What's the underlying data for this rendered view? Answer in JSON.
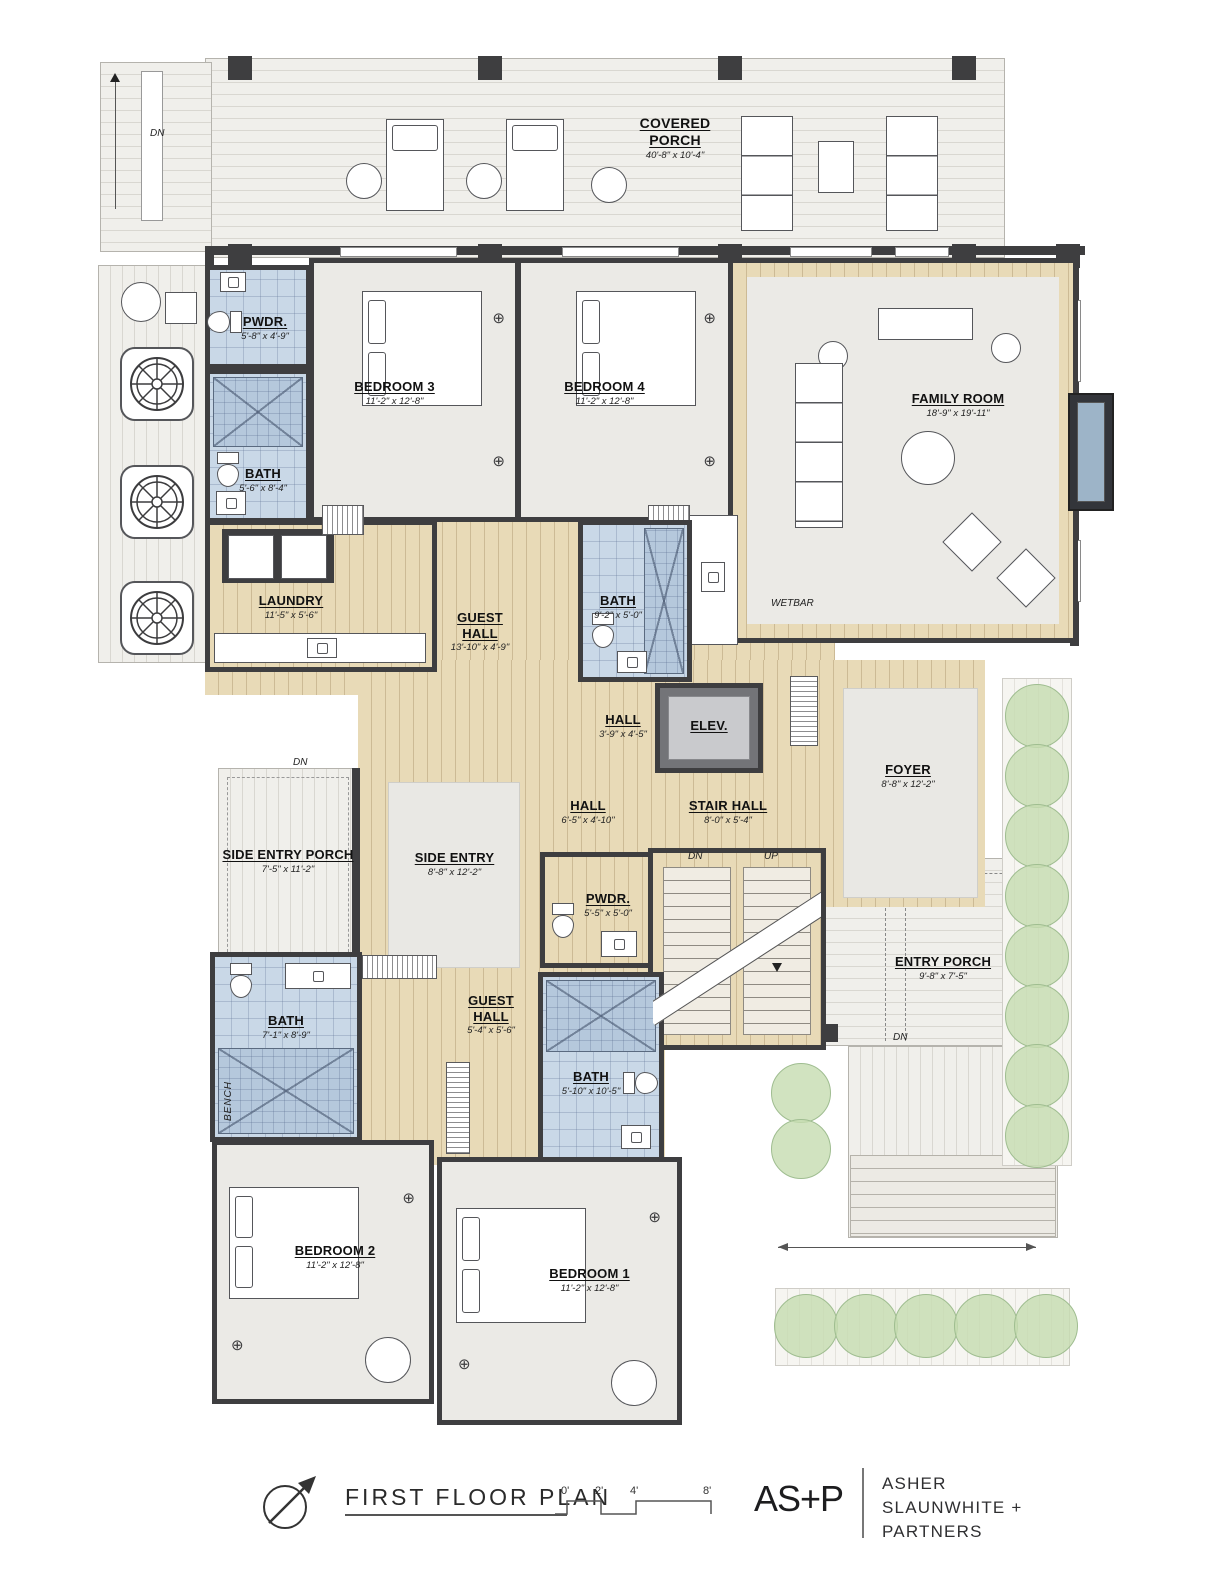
{
  "plan": {
    "rooms": {
      "covered_porch": {
        "name": "COVERED PORCH",
        "dim": "40'-8\" x 10'-4\""
      },
      "pwdr_upper": {
        "name": "PWDR.",
        "dim": "5'-8\" x 4'-9\""
      },
      "bath_upper": {
        "name": "BATH",
        "dim": "5'-6\" x 8'-4\""
      },
      "bedroom3": {
        "name": "BEDROOM 3",
        "dim": "11'-2\" x 12'-8\""
      },
      "bedroom4": {
        "name": "BEDROOM 4",
        "dim": "11'-2\" x 12'-8\""
      },
      "family_room": {
        "name": "FAMILY ROOM",
        "dim": "18'-9\" x 19'-11\""
      },
      "laundry": {
        "name": "LAUNDRY",
        "dim": "11'-5\" x 5'-6\""
      },
      "guest_hall_upper": {
        "name": "GUEST HALL",
        "dim": "13'-10\" x 4'-9\""
      },
      "bath_center": {
        "name": "BATH",
        "dim": "9'-2\" x 5'-0\""
      },
      "hall_small": {
        "name": "HALL",
        "dim": "3'-9\" x 4'-5\""
      },
      "elevator": {
        "name": "ELEV."
      },
      "foyer": {
        "name": "FOYER",
        "dim": "8'-8\" x 12'-2\""
      },
      "hall_center": {
        "name": "HALL",
        "dim": "6'-5\" x 4'-10\""
      },
      "stair_hall": {
        "name": "STAIR HALL",
        "dim": "8'-0\" x 5'-4\""
      },
      "side_entry_porch": {
        "name": "SIDE ENTRY PORCH",
        "dim": "7'-5\" x 11'-2\""
      },
      "side_entry": {
        "name": "SIDE ENTRY",
        "dim": "8'-8\" x 12'-2\""
      },
      "pwdr_lower": {
        "name": "PWDR.",
        "dim": "5'-5\" x 5'-0\""
      },
      "bath_lower_left": {
        "name": "BATH",
        "dim": "7'-1\" x 8'-9\""
      },
      "guest_hall_lower": {
        "name": "GUEST HALL",
        "dim": "5'-4\" x 5'-6\""
      },
      "bath_lower_right": {
        "name": "BATH",
        "dim": "5'-10\" x 10'-5\""
      },
      "bedroom2": {
        "name": "BEDROOM 2",
        "dim": "11'-2\" x 12'-8\""
      },
      "bedroom1": {
        "name": "BEDROOM 1",
        "dim": "11'-2\" x 12'-8\""
      },
      "entry_porch": {
        "name": "ENTRY PORCH",
        "dim": "9'-8\" x 7'-5\""
      }
    },
    "annotations": {
      "wetbar": "WETBAR",
      "bench": "BENCH",
      "down": "DN",
      "up": "UP"
    },
    "icons": {
      "light_fixture": "⊕"
    }
  },
  "footer": {
    "plan_title": "FIRST FLOOR PLAN",
    "scale_ticks": [
      "0'",
      "2'",
      "4'",
      "8'"
    ],
    "logo_text": "AS+P",
    "firm_lines": [
      "ASHER",
      "SLAUNWHITE +",
      "PARTNERS"
    ]
  },
  "colors": {
    "wall": "#3e3e40",
    "wood_floor": "#e8dab7",
    "tile_floor": "#c9d8e7",
    "carpet_floor": "#ebeae6",
    "deck": "#f0efeb",
    "garden": "#c5dcb0"
  }
}
